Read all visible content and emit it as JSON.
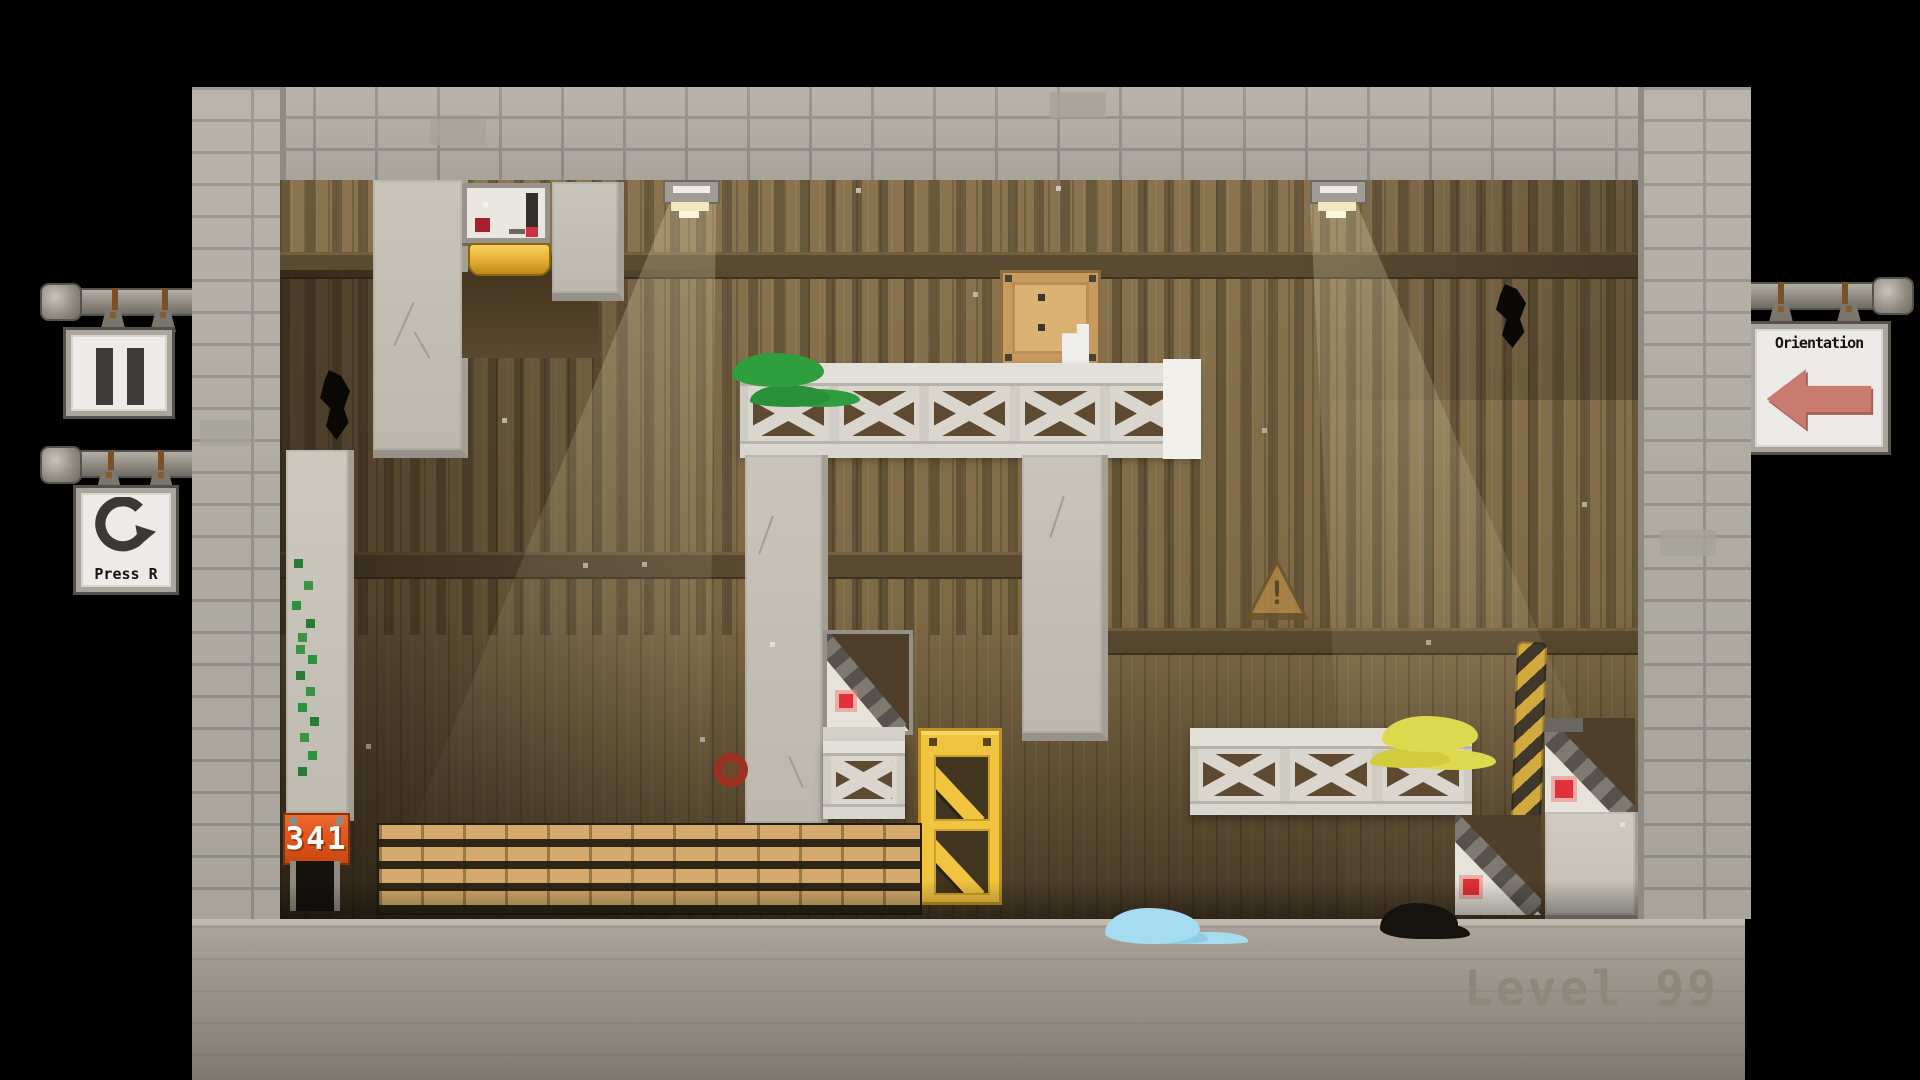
{
  "hud": {
    "pause_sign": {
      "icon": "pause-icon"
    },
    "restart_sign": {
      "label": "Press R",
      "icon": "restart-icon"
    },
    "orientation_sign": {
      "label": "Orientation",
      "icon": "arrow-left-icon"
    }
  },
  "counter": {
    "value": "341"
  },
  "level": {
    "label": "Level 99"
  },
  "colors": {
    "counter_bg": "#e2571f",
    "arrow_salmon": "#c97b70",
    "truss_yellow": "#f1c440",
    "hazard_yellow": "#d1a93e",
    "moss_green": "#2f9e3f",
    "moss_yellow": "#ded84f",
    "splat_cyan": "#a5dcef",
    "ramp_marker_red": "#e03038"
  }
}
